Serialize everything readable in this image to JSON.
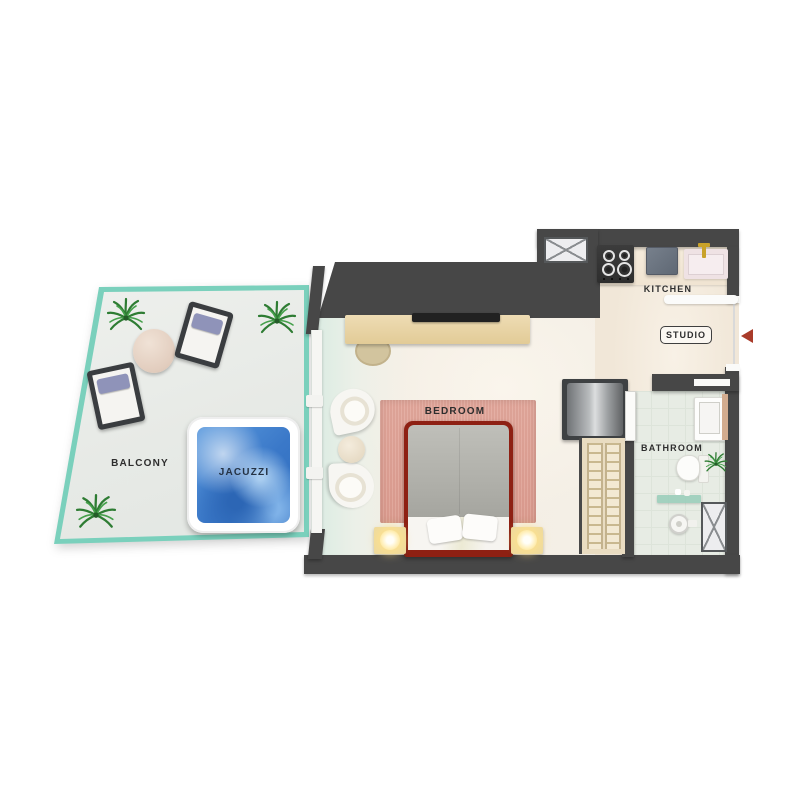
{
  "image_type": "3d-floor-plan-top-view",
  "rooms": {
    "balcony": {
      "label": "BALCONY"
    },
    "jacuzzi": {
      "label": "JACUZZI"
    },
    "bedroom": {
      "label": "BEDROOM"
    },
    "kitchen": {
      "label": "KITCHEN"
    },
    "studio": {
      "label": "STUDIO"
    },
    "bathroom": {
      "label": "BATHROOM"
    }
  },
  "icons": {
    "entrance_arrow": "◀",
    "service_shaft": "☒",
    "palm_plant": "✾",
    "stove_burners": "◉◉◉◉",
    "shower_head": "◎"
  },
  "colors": {
    "wall": "#474747",
    "balcony_rail_glass": "#7ad0bc",
    "balcony_floor": "#e9ece8",
    "interior_floor": "#f3ece2",
    "bathroom_tile": "#e7ece4",
    "jacuzzi_water": "#3a78c8",
    "rug": "#e0a295",
    "bed_frame": "#8e2013",
    "wood_console": "#e9d5a9",
    "nightstand": "#eeda9e",
    "lamp_glow": "#ffedb0",
    "fridge": "#6b7380",
    "metal_tank": "#b9bcbe",
    "faucet_gold": "#c9a22a",
    "pillow_lavender": "#8f93b9",
    "plant_green": "#2e7c33",
    "entry_arrow": "#a93b2a"
  }
}
